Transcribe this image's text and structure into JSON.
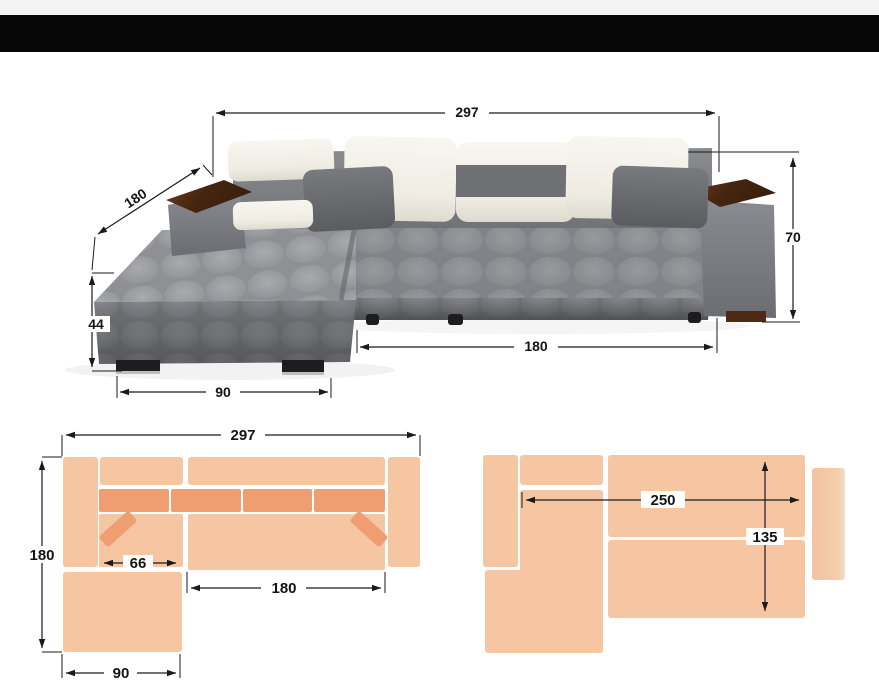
{
  "figure": {
    "subject": "corner-sofa-dimension-diagram"
  },
  "dims": {
    "photo": {
      "width": "297",
      "depth": "180",
      "height": "70",
      "ottoman_height": "44",
      "ottoman_width": "90",
      "seat_length": "180"
    },
    "plan_top": {
      "width": "297",
      "depth": "180",
      "inner_width": "66",
      "seat_length": "180",
      "ottoman_width": "90"
    },
    "plan_bed": {
      "bed_length": "250",
      "bed_depth": "135"
    }
  },
  "colors": {
    "top_strip": "#f3f3f3",
    "top_bar": "#070707",
    "plan_light": "#f6c6a2",
    "plan_dark": "#ee9e70",
    "plan_arm_fade": "#f3c9a9",
    "dim_line": "#1a1a1a",
    "sofa_gray": "#8a8b8f",
    "pillow_white": "#f2efe8",
    "wood": "#4c2a15"
  }
}
